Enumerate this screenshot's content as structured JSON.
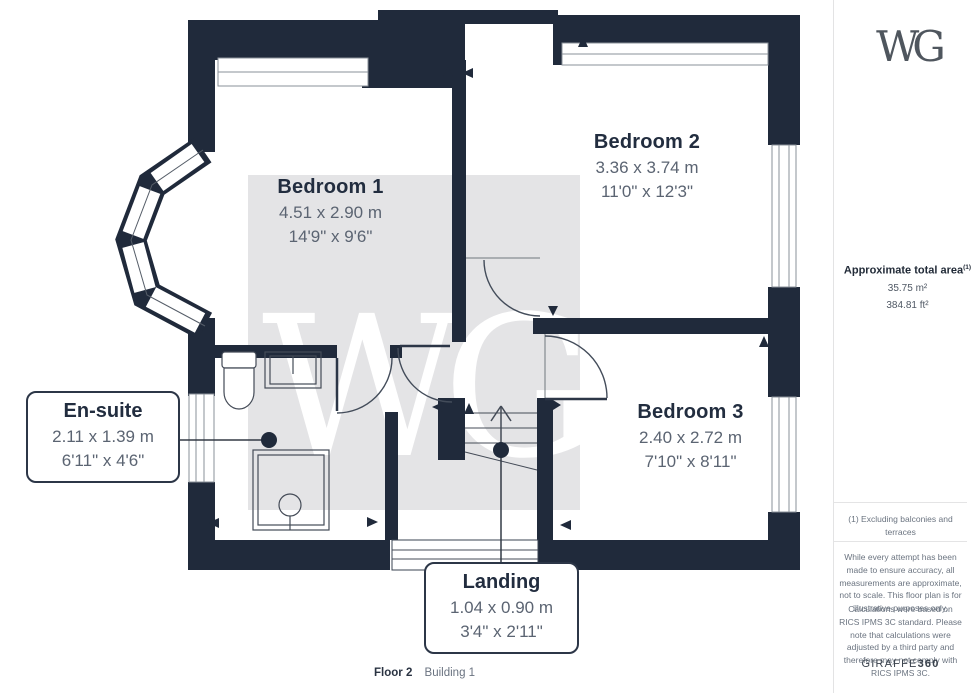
{
  "logo": {
    "text": "WG"
  },
  "plan": {
    "watermark_text": "WG",
    "rooms": [
      {
        "name": "Bedroom 1",
        "metric": "4.51 x 2.90 m",
        "imperial": "14'9\" x 9'6\""
      },
      {
        "name": "Bedroom 2",
        "metric": "3.36 x 3.74 m",
        "imperial": "11'0\" x 12'3\""
      },
      {
        "name": "Bedroom 3",
        "metric": "2.40 x 2.72 m",
        "imperial": "7'10\" x 8'11\""
      }
    ],
    "callouts": [
      {
        "name": "En-suite",
        "metric": "2.11 x 1.39 m",
        "imperial": "6'11\" x 4'6\""
      },
      {
        "name": "Landing",
        "metric": "1.04 x 0.90 m",
        "imperial": "3'4\" x 2'11\""
      }
    ]
  },
  "sidebar": {
    "area_title": "Approximate total area",
    "area_sup": "(1)",
    "area_m2": "35.75 m²",
    "area_ft2": "384.81 ft²",
    "footnote": "(1) Excluding balconies and terraces",
    "disclaimer1": "While every attempt has been made to ensure accuracy, all measurements are approximate, not to scale. This floor plan is for illustrative purposes only.",
    "disclaimer2": "Calculations were based on RICS IPMS 3C standard. Please note that calculations were adjusted by a third party and therefore may not comply with RICS IPMS 3C.",
    "brand_name": "GIRAFFE",
    "brand_suffix": "360"
  },
  "caption": {
    "floor": "Floor 2",
    "building": "Building 1"
  },
  "colors": {
    "wall": "#202a3b",
    "label_title": "#222d3f",
    "label_dim": "#5b6472",
    "watermark_bg": "#e4e4e6"
  }
}
